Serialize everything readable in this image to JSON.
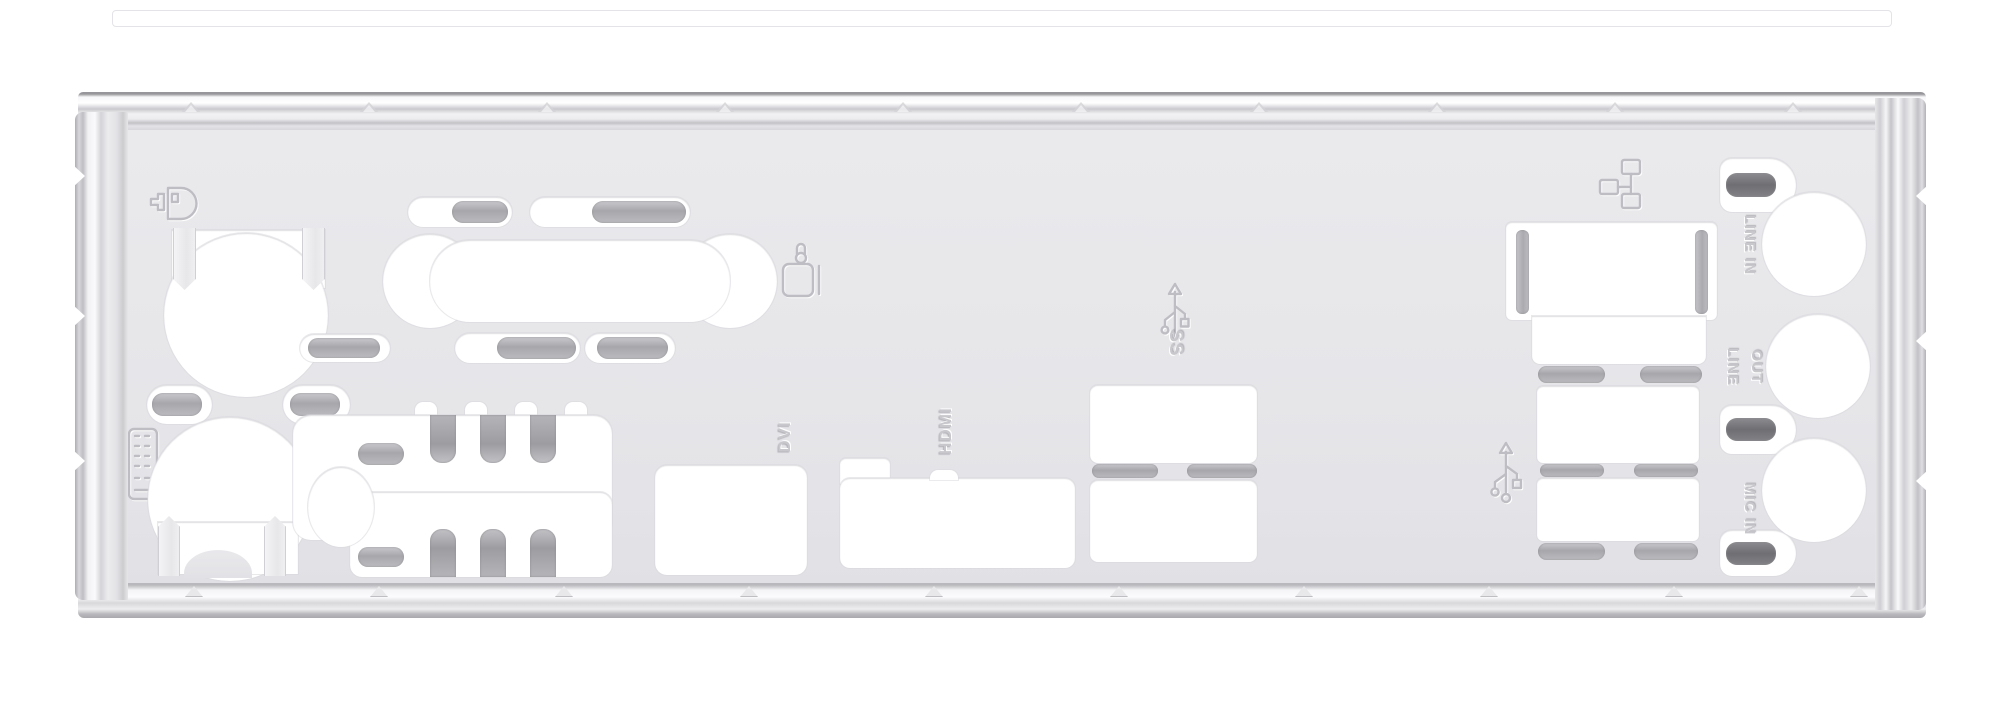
{
  "photo": {
    "subject": "motherboard rear I/O shield backplate",
    "background_color": "#ffffff",
    "plate_color": "#e7e7ea",
    "cutout_color": "#ffffff",
    "spring_tab_color": "#a7a7ab",
    "dark_tab_color": "#6f6f73",
    "emboss_color": "#c7c7cc"
  },
  "markings": {
    "dvi": "DVI",
    "hdmi": "HDMI",
    "usb3_ss": "SS",
    "line_in": "LINE IN",
    "line_out_line1": "LINE",
    "line_out_line2": "OUT",
    "mic_in": "MIC IN"
  },
  "icons": {
    "ps2_mouse": "ps2-mouse-icon",
    "keyboard": "keyboard-icon",
    "display": "display-connector-icon",
    "usb3_trident": "usb-superspeed-trident-icon",
    "usb2_trident": "usb-trident-icon",
    "lan": "ethernet-lan-icon"
  }
}
